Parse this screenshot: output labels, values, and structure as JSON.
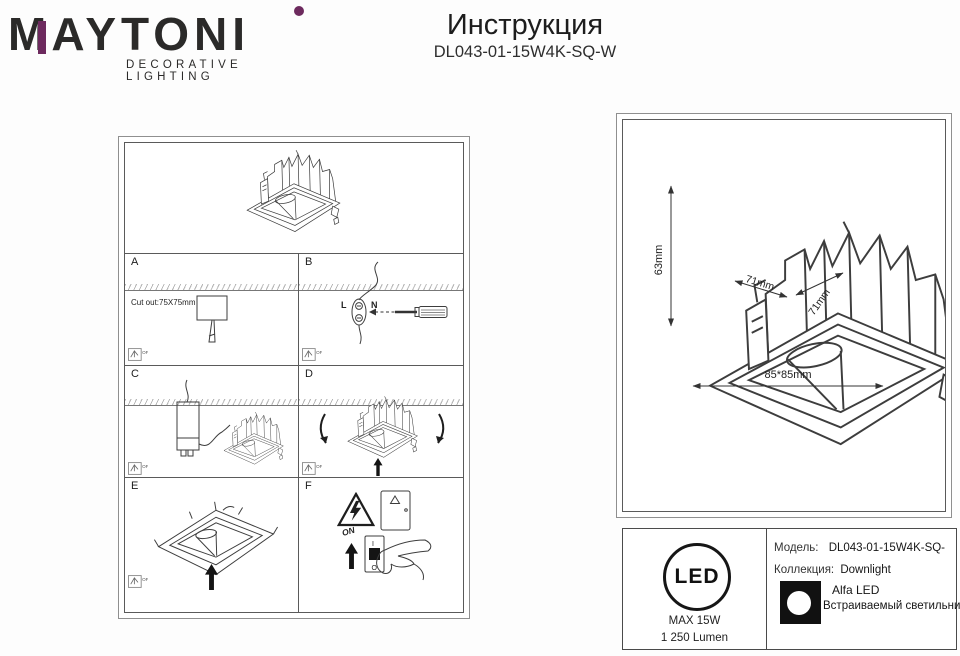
{
  "header": {
    "brand": "MAYTONI",
    "brand_sub": "DECORATIVE LIGHTING",
    "title": "Инструкция",
    "model_code": "DL043-01-15W4K-SQ-W",
    "accent_color": "#6d2a5e",
    "ink_color": "#2b2a29"
  },
  "install": {
    "off_label": "OFF",
    "panels": [
      {
        "id": "A",
        "note": "Cut out:75X75mm"
      },
      {
        "id": "B",
        "wire_left": "L",
        "wire_right": "N"
      },
      {
        "id": "C"
      },
      {
        "id": "D"
      },
      {
        "id": "E"
      },
      {
        "id": "F",
        "on_label": "ON",
        "switch_top": "I",
        "switch_bottom": "O"
      }
    ]
  },
  "dims": {
    "height": "63mm",
    "inner_a": "71mm",
    "inner_b": "71mm",
    "overall": "85*85mm"
  },
  "badge": {
    "led": "LED",
    "max_power": "MAX 15W",
    "lumens": "1 250 Lumen"
  },
  "product": {
    "model_label": "Модель:",
    "model_value": "DL043-01-15W4K-SQ-",
    "collection_label": "Коллекция:",
    "collection_value": "Downlight",
    "series": "Alfa LED",
    "type_text": "Встраиваемый светильник"
  }
}
